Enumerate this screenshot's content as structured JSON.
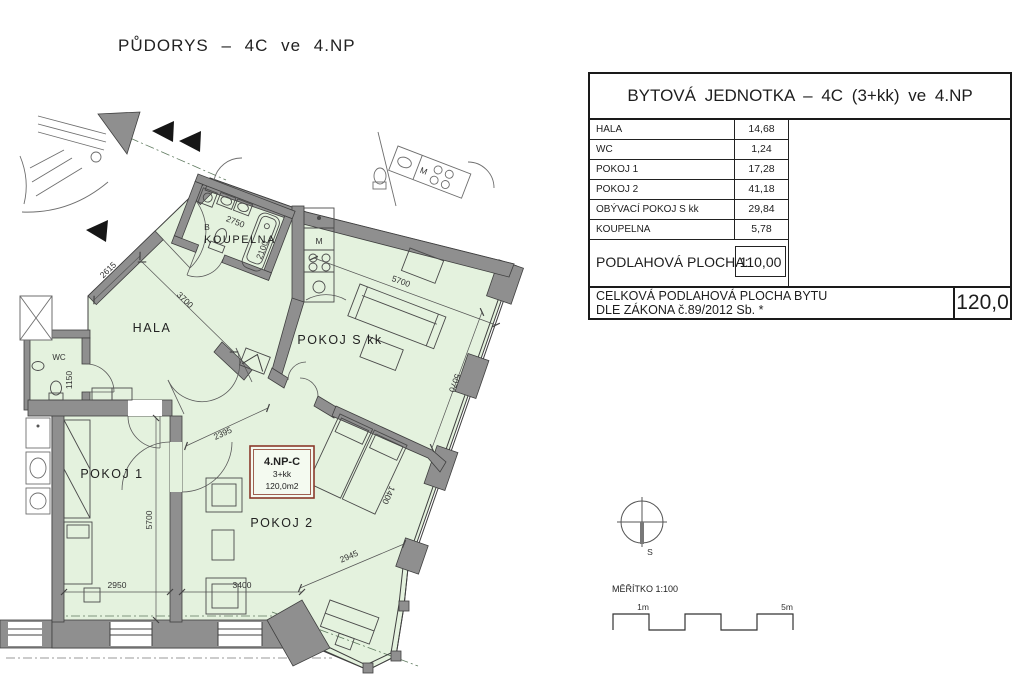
{
  "title": "PŮDORYS – 4C ve 4.NP",
  "plan": {
    "rooms": {
      "hala": "HALA",
      "koupelna": "KOUPELNA",
      "wc": "WC",
      "pokoj1": "POKOJ 1",
      "pokoj2": "POKOJ 2",
      "pokoj_s_kk": "POKOJ S kk"
    },
    "letters": {
      "bathroom": "B",
      "kitchen": "M",
      "neighbor_kitchen": "M"
    },
    "unit_label": {
      "line1": "4.NP-C",
      "line2": "3+kk",
      "line3": "120,0m2"
    },
    "dimensions": {
      "koupelna_width": "2750",
      "koupelna_depth": "2100",
      "hala_entry": "2615",
      "hala_diag": "3700",
      "wc_width": "1150",
      "hala_pokoj2_opening": "2395",
      "pokoj1_width": "2950",
      "pokoj1_depth": "5700",
      "pokoj2_width": "3400",
      "pokoj2_bay": "2945",
      "obyvaci_width": "5700",
      "obyvaci_depth": "5070",
      "bed_width": "1400"
    }
  },
  "table": {
    "title": "BYTOVÁ JEDNOTKA – 4C (3+kk) ve 4.NP",
    "rows": [
      {
        "label": "HALA",
        "value": "14,68"
      },
      {
        "label": "WC",
        "value": "1,24"
      },
      {
        "label": "POKOJ 1",
        "value": "17,28"
      },
      {
        "label": "POKOJ 2",
        "value": "41,18"
      },
      {
        "label": "OBÝVACÍ POKOJ S kk",
        "value": "29,84"
      },
      {
        "label": "KOUPELNA",
        "value": "5,78"
      }
    ],
    "floor_area_label": "PODLAHOVÁ PLOCHA:",
    "floor_area_value": "110,00",
    "total_label_line1": "CELKOVÁ PODLAHOVÁ PLOCHA BYTU",
    "total_label_line2": "DLE ZÁKONA č.89/2012 Sb. *",
    "total_value": "120,0"
  },
  "compass": {
    "south_label": "S"
  },
  "scale_bar": {
    "title": "MĚŘÍTKO 1:100",
    "start_label": "1m",
    "end_label": "5m"
  },
  "colors": {
    "apartment_fill": "#e4f2de",
    "wall_fill": "#8f8f8f",
    "unit_box_border": "#8a3a2a",
    "line": "#3f3f3f"
  }
}
